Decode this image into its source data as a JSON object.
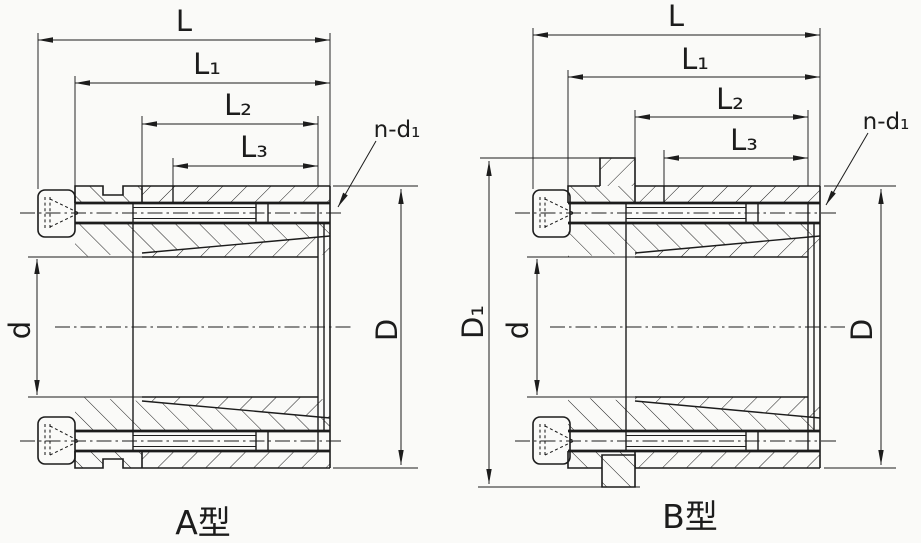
{
  "colors": {
    "line": "#1c1c1c",
    "paper": "#fafaf8"
  },
  "drawings": [
    {
      "caption": "A型",
      "labels": {
        "L": "L",
        "L1": "L₁",
        "L2": "L₂",
        "L3": "L₃",
        "n_d1": "n-d₁",
        "d": "d",
        "D": "D"
      }
    },
    {
      "caption": "B型",
      "labels": {
        "L": "L",
        "L1": "L₁",
        "L2": "L₂",
        "L3": "L₃",
        "n_d1": "n-d₁",
        "d": "d",
        "D": "D",
        "D1": "D₁"
      }
    }
  ]
}
